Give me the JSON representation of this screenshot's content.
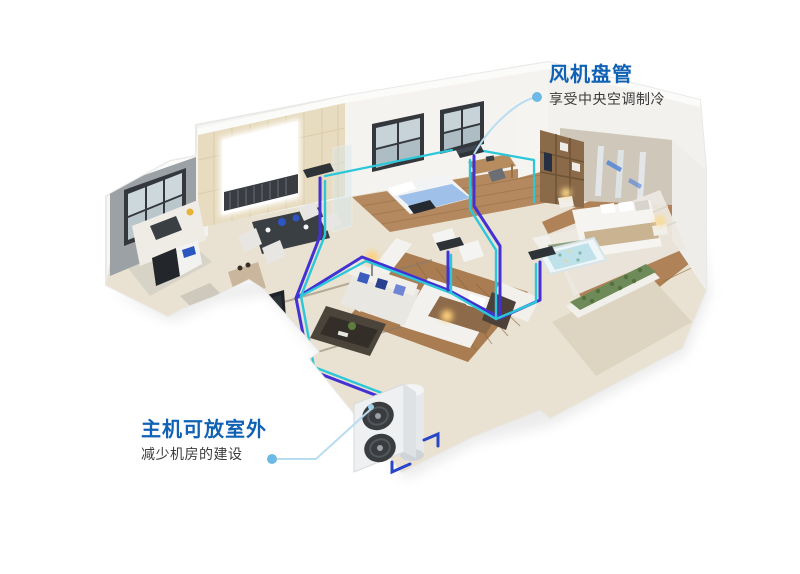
{
  "callouts": {
    "fan_coil": {
      "title": "风机盘管",
      "subtitle": "享受中央空调制冷"
    },
    "outdoor_unit": {
      "title": "主机可放室外",
      "subtitle": "减少机房的建设"
    }
  },
  "colors": {
    "title_blue": "#1062b4",
    "subtitle_gray": "#3b3b3b",
    "leader_line": "#b8ddf1",
    "leader_dot": "#6cb9e6",
    "pipe_cyan": "#2cc7d8",
    "pipe_indigo": "#4331d3",
    "pipe_blue": "#2a46c8"
  }
}
